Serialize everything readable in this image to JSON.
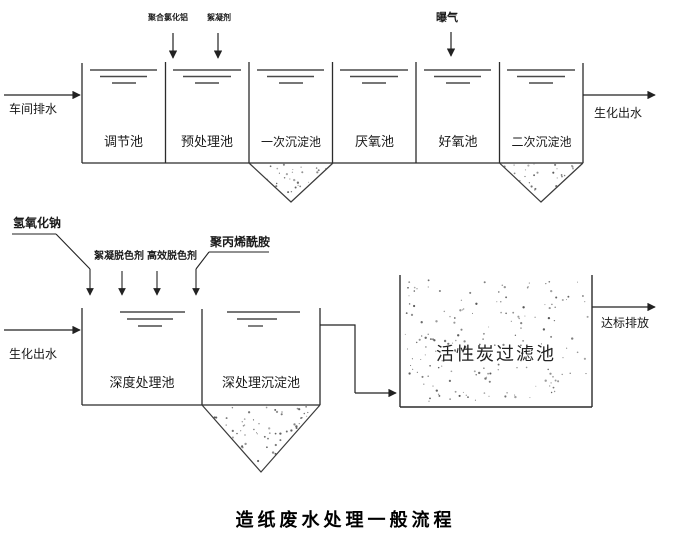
{
  "diagram_title": "造纸废水处理一般流程",
  "top_process": {
    "inflow": "车间排水",
    "outflow": "生化出水",
    "dosing": {
      "pac": "聚合氯化铝",
      "flocculant": "絮凝剂",
      "aeration": "曝气"
    },
    "tanks": [
      "调节池",
      "预处理池",
      "一次沉淀池",
      "厌氧池",
      "好氧池",
      "二次沉淀池"
    ]
  },
  "bottom_process": {
    "inflow": "生化出水",
    "outflow": "达标排放",
    "dosing": {
      "naoh": "氢氧化钠",
      "floc_decolorant": "絮凝脱色剂",
      "high_eff_decolorant": "高效脱色剂",
      "pam": "聚丙烯酰胺"
    },
    "tanks": [
      "深度处理池",
      "深处理沉淀池"
    ],
    "filter_tank": "活性炭过滤池"
  },
  "colors": {
    "line": "#2b2b2b",
    "water_line": "#4a4a4a",
    "stipple": "#555555"
  }
}
